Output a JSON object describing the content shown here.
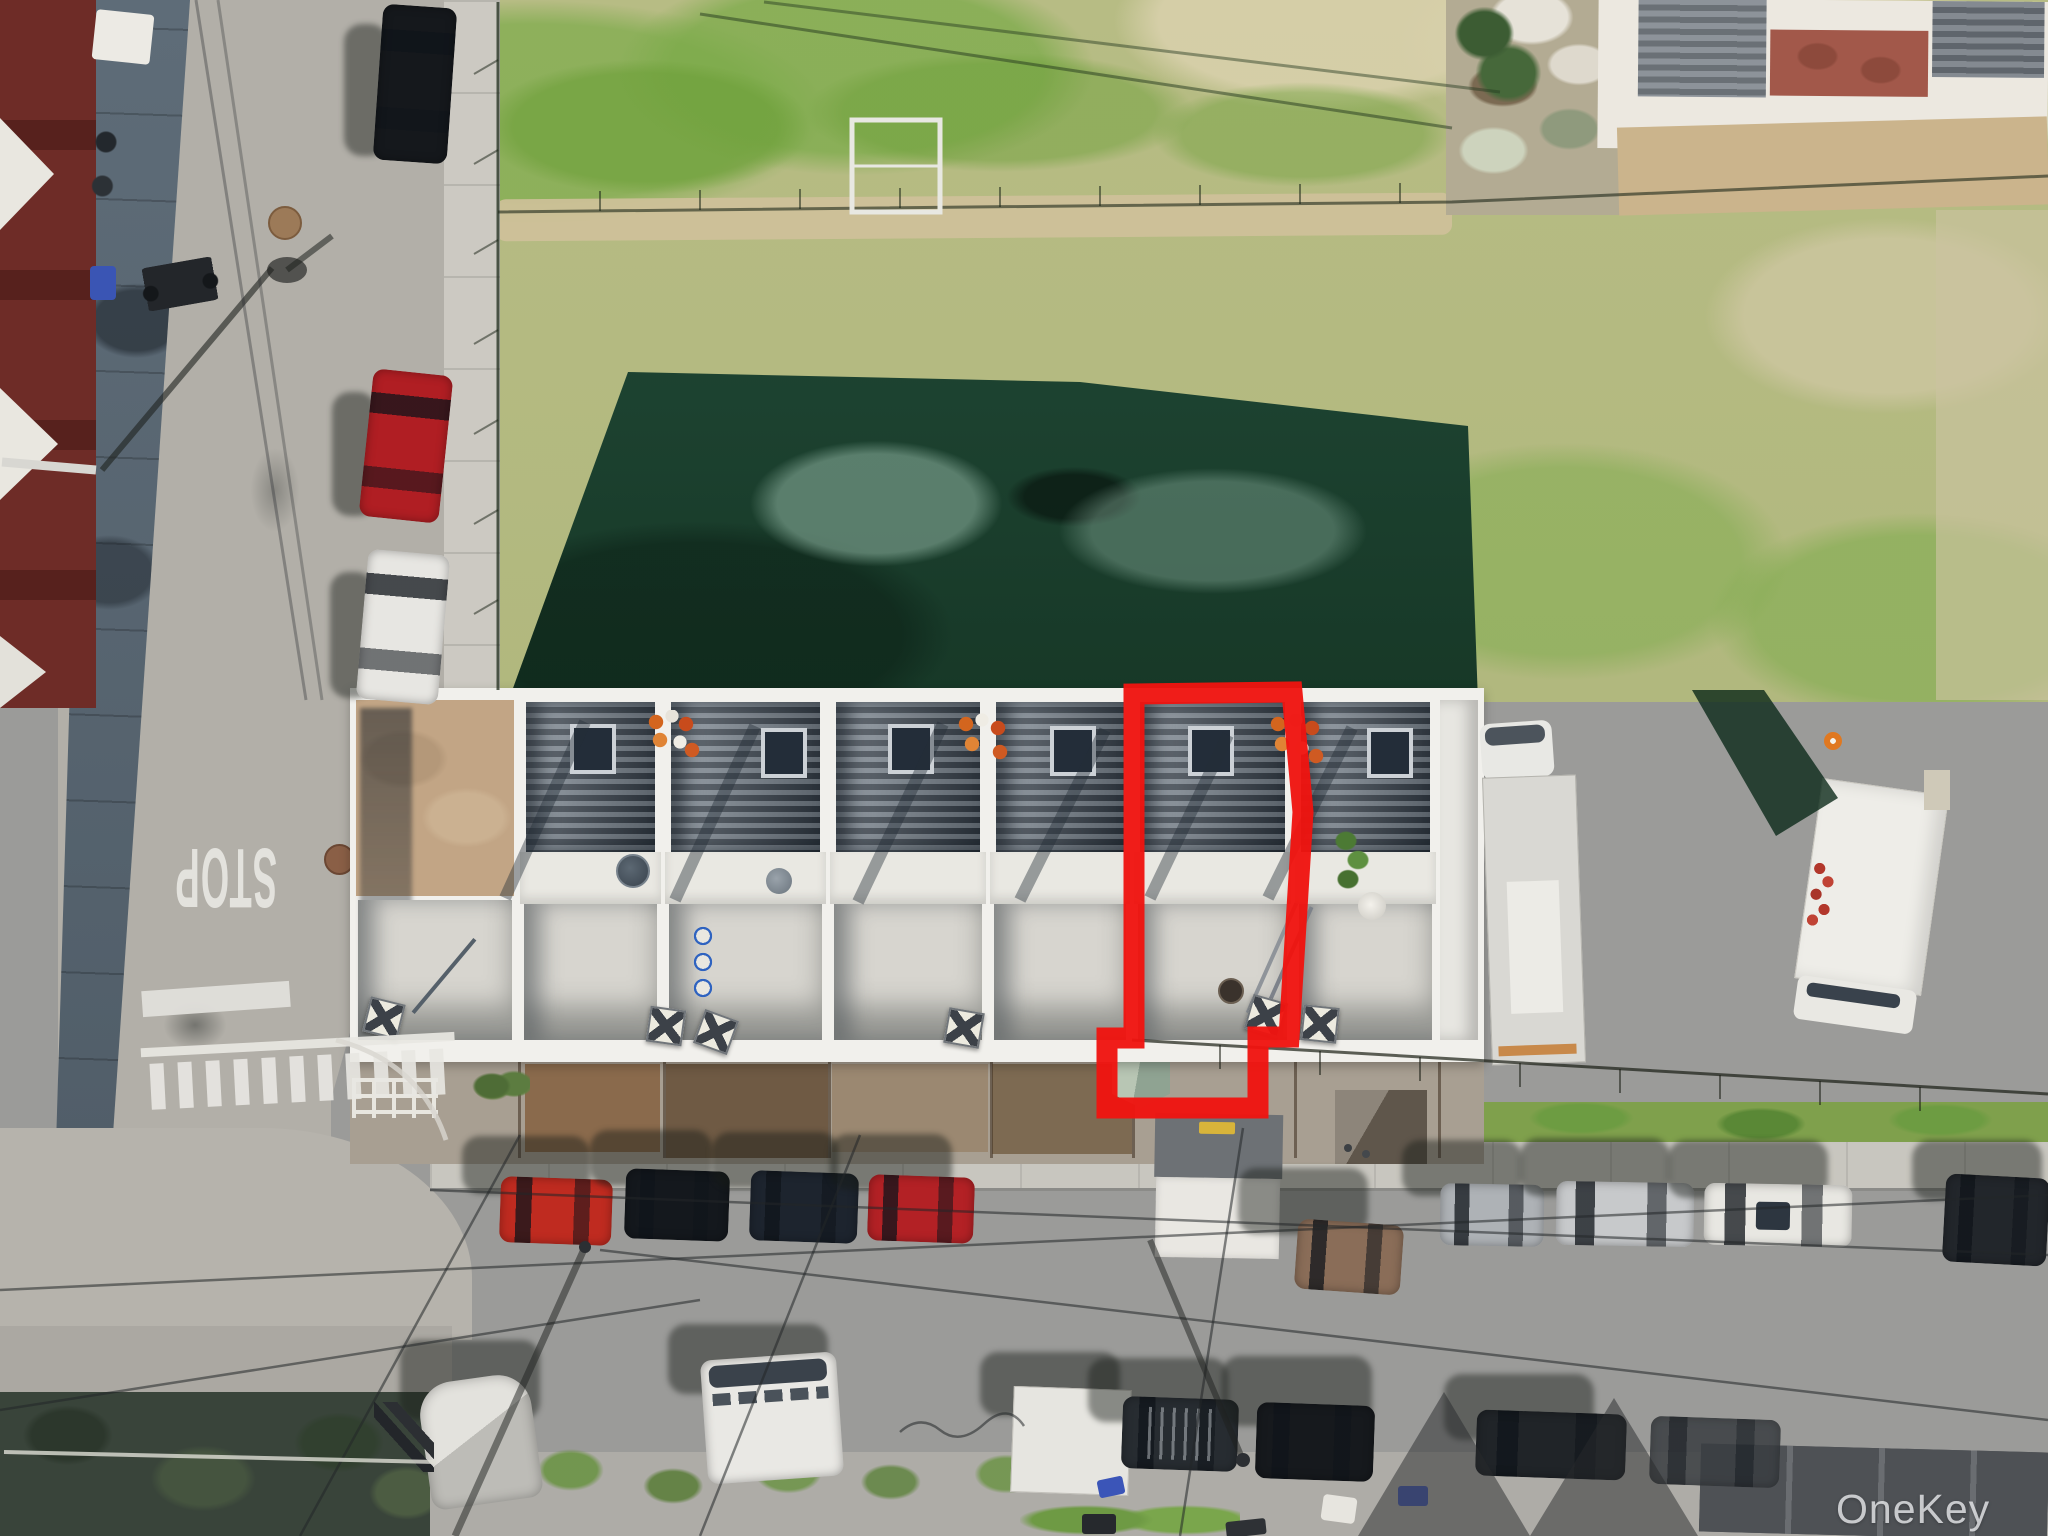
{
  "scene": {
    "kind": "aerial drone photograph",
    "subject": "row of townhouses with one unit outlined in red, vacant grass lot behind, streets with parked cars",
    "annotation_color": "#ef1410"
  },
  "watermark": {
    "text": "OneKey MLS",
    "color": "#eef0f2"
  },
  "road_markings": {
    "stop_text": "STOP"
  },
  "palette": {
    "grass": "#b5ba82",
    "grass_shadow": "#1c4231",
    "street": "#9b9b99",
    "left_street": "#b2afa8",
    "sidewalk": "#c7c5be",
    "roof_white": "#f1f0ec",
    "shingle_dark": "#333d48",
    "left_buildings": "#6e2c27"
  }
}
